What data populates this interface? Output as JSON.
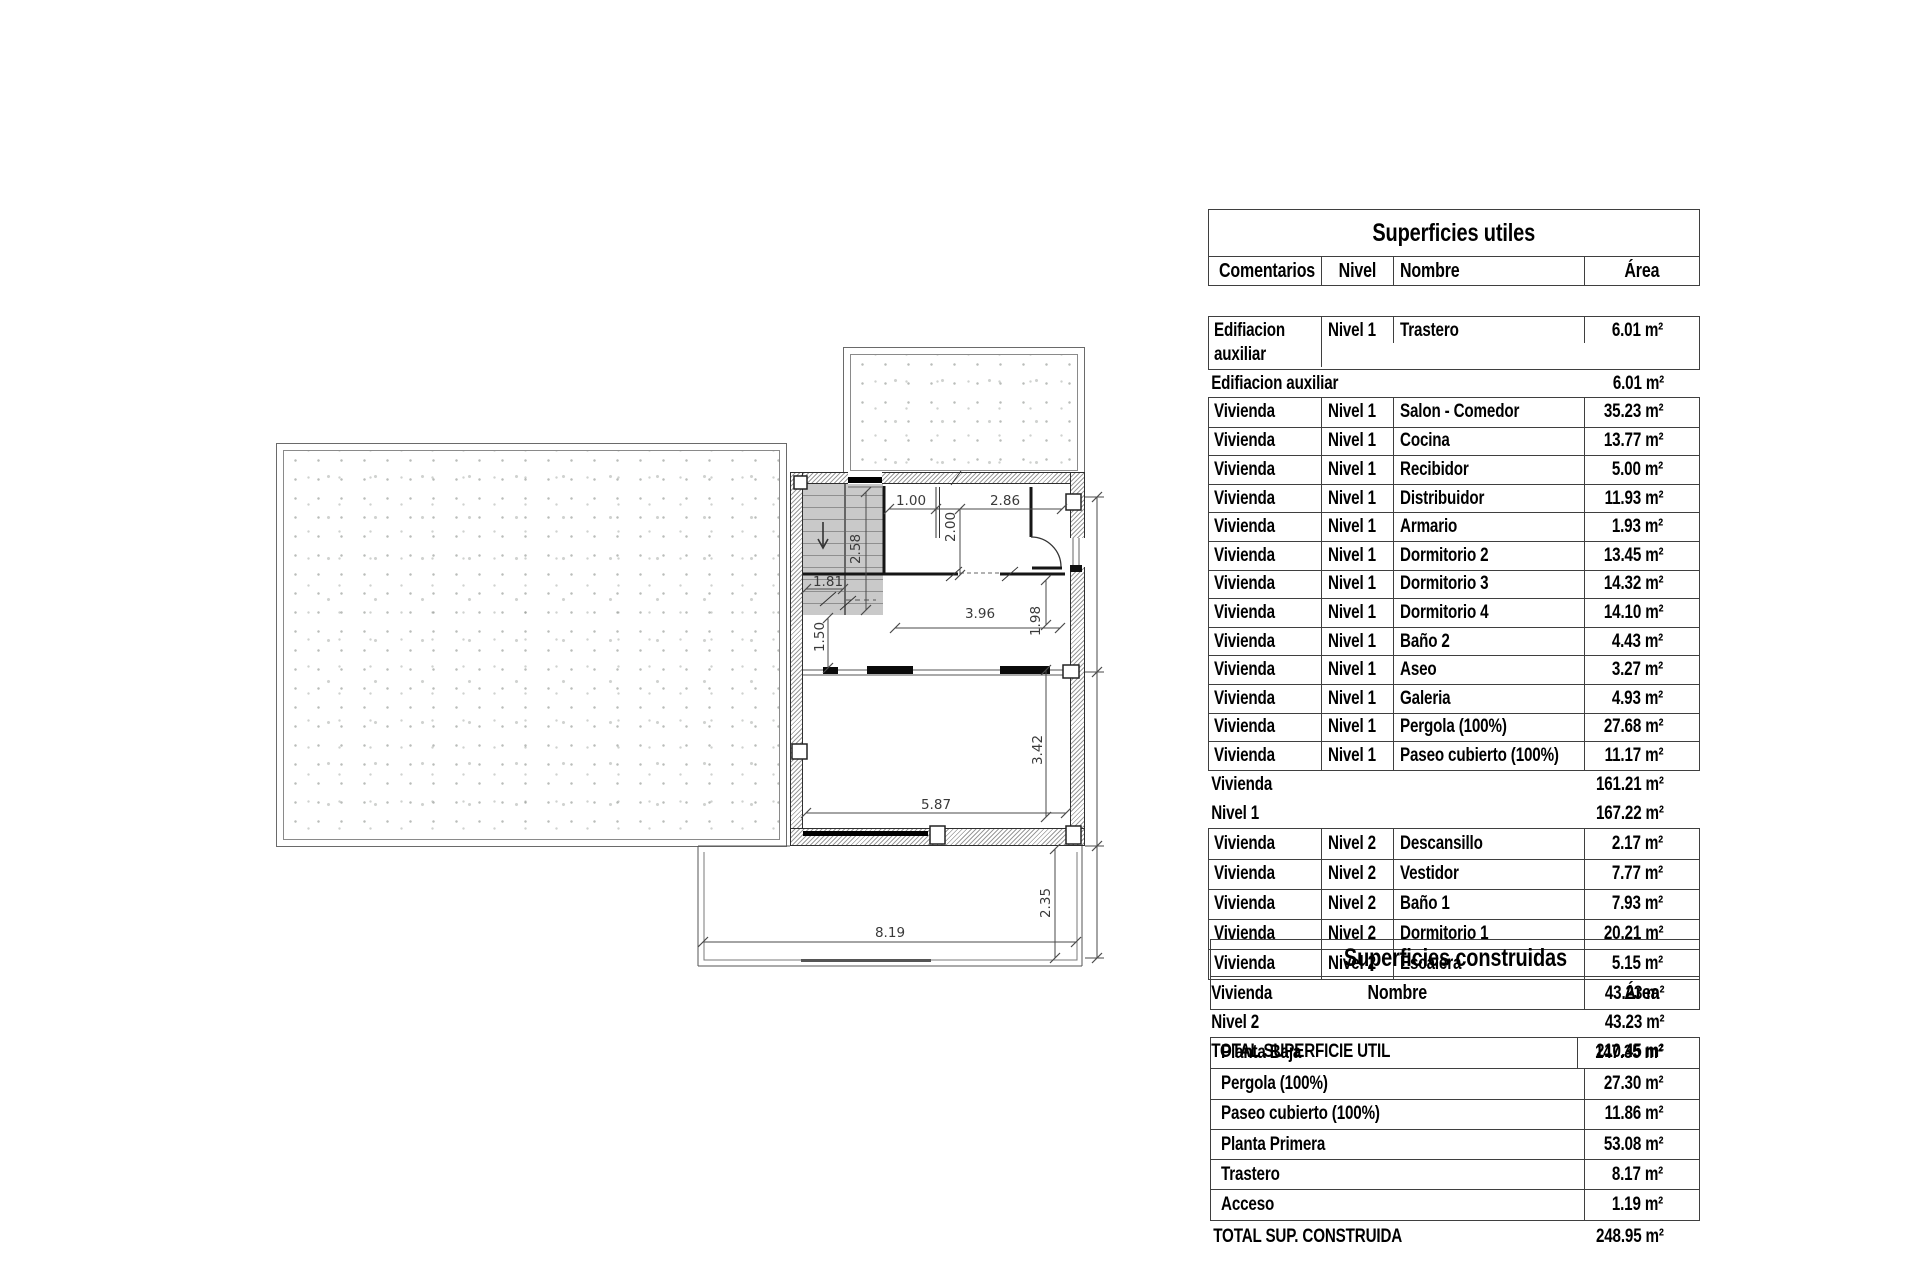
{
  "plan": {
    "dimensions": [
      {
        "value": "1.00",
        "x": 911,
        "y": 501,
        "vertical": false
      },
      {
        "value": "2.86",
        "x": 1005,
        "y": 501,
        "vertical": false
      },
      {
        "value": "2.00",
        "x": 951,
        "y": 527,
        "vertical": true
      },
      {
        "value": "2.58",
        "x": 856,
        "y": 549,
        "vertical": true
      },
      {
        "value": "1.81",
        "x": 828,
        "y": 582,
        "vertical": false
      },
      {
        "value": "1.50",
        "x": 820,
        "y": 637,
        "vertical": true
      },
      {
        "value": "3.96",
        "x": 980,
        "y": 614,
        "vertical": false
      },
      {
        "value": "1.98",
        "x": 1036,
        "y": 621,
        "vertical": true
      },
      {
        "value": "3.42",
        "x": 1038,
        "y": 750,
        "vertical": true
      },
      {
        "value": "5.87",
        "x": 936,
        "y": 805,
        "vertical": false
      },
      {
        "value": "8.19",
        "x": 890,
        "y": 933,
        "vertical": false
      },
      {
        "value": "2.35",
        "x": 1046,
        "y": 903,
        "vertical": true
      }
    ]
  },
  "tables": {
    "utiles": {
      "title": "Superficies utiles",
      "headers": {
        "comments": "Comentarios",
        "level": "Nivel",
        "name": "Nombre",
        "area": "Área"
      },
      "block1": [
        {
          "comments": "Edifiacion auxiliar",
          "level": "Nivel 1",
          "name": "Trastero",
          "area": "6.01 m²"
        }
      ],
      "sub1": [
        {
          "label": "Edifiacion auxiliar",
          "area": "6.01 m²"
        }
      ],
      "block2": [
        {
          "comments": "Vivienda",
          "level": "Nivel 1",
          "name": "Salon - Comedor",
          "area": "35.23 m²"
        },
        {
          "comments": "Vivienda",
          "level": "Nivel 1",
          "name": "Cocina",
          "area": "13.77 m²"
        },
        {
          "comments": "Vivienda",
          "level": "Nivel 1",
          "name": "Recibidor",
          "area": "5.00 m²"
        },
        {
          "comments": "Vivienda",
          "level": "Nivel 1",
          "name": "Distribuidor",
          "area": "11.93 m²"
        },
        {
          "comments": "Vivienda",
          "level": "Nivel 1",
          "name": "Armario",
          "area": "1.93 m²"
        },
        {
          "comments": "Vivienda",
          "level": "Nivel 1",
          "name": "Dormitorio 2",
          "area": "13.45 m²"
        },
        {
          "comments": "Vivienda",
          "level": "Nivel 1",
          "name": "Dormitorio 3",
          "area": "14.32 m²"
        },
        {
          "comments": "Vivienda",
          "level": "Nivel 1",
          "name": "Dormitorio 4",
          "area": "14.10 m²"
        },
        {
          "comments": "Vivienda",
          "level": "Nivel 1",
          "name": "Baño 2",
          "area": "4.43 m²"
        },
        {
          "comments": "Vivienda",
          "level": "Nivel 1",
          "name": "Aseo",
          "area": "3.27 m²"
        },
        {
          "comments": "Vivienda",
          "level": "Nivel 1",
          "name": "Galeria",
          "area": "4.93 m²"
        },
        {
          "comments": "Vivienda",
          "level": "Nivel 1",
          "name": "Pergola (100%)",
          "area": "27.68 m²"
        },
        {
          "comments": "Vivienda",
          "level": "Nivel 1",
          "name": "Paseo cubierto (100%)",
          "area": "11.17 m²"
        }
      ],
      "sub2": [
        {
          "label": "Vivienda",
          "area": "161.21 m²"
        },
        {
          "label": "Nivel 1",
          "area": "167.22 m²"
        }
      ],
      "block3": [
        {
          "comments": "Vivienda",
          "level": "Nivel 2",
          "name": "Descansillo",
          "area": "2.17 m²"
        },
        {
          "comments": "Vivienda",
          "level": "Nivel 2",
          "name": "Vestidor",
          "area": "7.77 m²"
        },
        {
          "comments": "Vivienda",
          "level": "Nivel 2",
          "name": "Baño 1",
          "area": "7.93 m²"
        },
        {
          "comments": "Vivienda",
          "level": "Nivel 2",
          "name": "Dormitorio 1",
          "area": "20.21 m²"
        },
        {
          "comments": "Vivienda",
          "level": "Nivel 2",
          "name": "Escalera",
          "area": "5.15 m²"
        }
      ],
      "sub3": [
        {
          "label": "Vivienda",
          "area": "43.23 m²"
        },
        {
          "label": "Nivel 2",
          "area": "43.23 m²"
        },
        {
          "label": "TOTAL SUPERFICIE UTIL",
          "area": "210.45 m²"
        }
      ]
    },
    "construidas": {
      "title": "Superficies construidas",
      "headers": {
        "name": "Nombre",
        "area": "Área"
      },
      "rows": [
        {
          "name": "Planta Baja",
          "area": "147.35 m²"
        },
        {
          "name": "Pergola (100%)",
          "area": "27.30 m²"
        },
        {
          "name": "Paseo cubierto (100%)",
          "area": "11.86 m²"
        },
        {
          "name": "Planta Primera",
          "area": "53.08 m²"
        },
        {
          "name": "Trastero",
          "area": "8.17 m²"
        },
        {
          "name": "Acceso",
          "area": "1.19 m²"
        }
      ],
      "total": {
        "label": "TOTAL SUP. CONSTRUIDA",
        "area": "248.95 m²"
      }
    }
  }
}
